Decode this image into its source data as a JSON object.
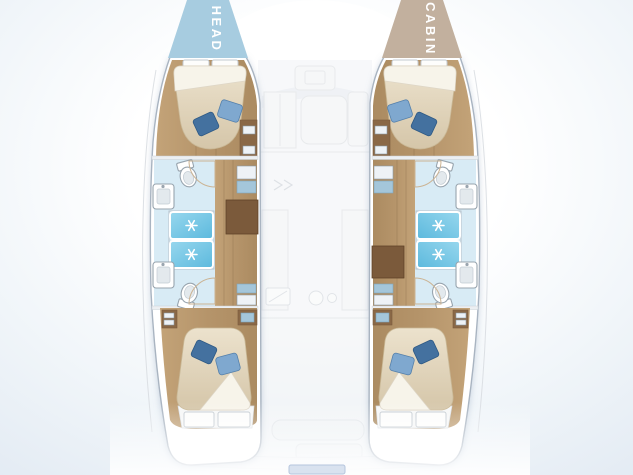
{
  "diagram": {
    "type": "boat-floorplan",
    "subject": "catamaran hull deck layout"
  },
  "labels": {
    "left_bow": "HEAD",
    "right_bow": "CABIN"
  },
  "colors": {
    "head_triangle": "#a7cce0",
    "cabin_triangle": "#c2b09e",
    "label_text": "#ffffff",
    "hull_fill": "#ffffff",
    "hull_stroke": "#a9b4c1",
    "wood_light": "#c3a378",
    "wood_mid": "#aa8a60",
    "wood_dark": "#8a6846",
    "mattress": "#d9cbb2",
    "sheet": "#f7f4ea",
    "pillow_dark": "#44719f",
    "pillow_light": "#7fa8cf",
    "bath_floor": "#d8ebf5",
    "shower_blue": "#6ec4e4",
    "cabinet_blue": "#a4c6da",
    "steps_brown": "#7b5a3b",
    "step_stripe": "#a5825e",
    "fixture_stroke": "#98a4ae",
    "faded_fill": "#eff1f3",
    "faded_stroke": "#d6dade",
    "water_edge": "#e2eaf3"
  },
  "icons": {
    "shower_spray": "white-asterisk-star",
    "toilet": "oval-wc-with-tank",
    "sink": "square-basin",
    "pillow": "rotated-blue-square",
    "companionway_steps": "striped-brown-ladder"
  },
  "features": {
    "hulls": [
      {
        "name": "port-hull",
        "compartments": [
          "forward-cabin",
          "forward-head",
          "shower-stalls",
          "aft-head",
          "aft-cabin"
        ]
      },
      {
        "name": "starboard-hull",
        "compartments": [
          "forward-cabin",
          "forward-head",
          "shower-stalls",
          "aft-head",
          "aft-cabin"
        ]
      }
    ],
    "center": [
      "saloon-faded",
      "cockpit-faded",
      "swim-platform-faded"
    ]
  }
}
